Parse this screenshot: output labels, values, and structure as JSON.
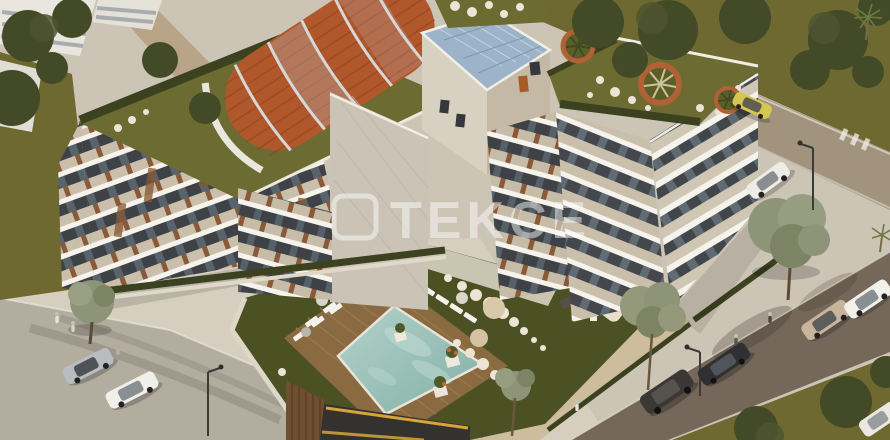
{
  "watermark": {
    "text": "TEKCE",
    "color": "#ffffff",
    "opacity": "0.48"
  },
  "palette": {
    "pavement": "#ccc5b6",
    "sidewalk": "#d6cfc0",
    "road_light": "#b3ada0",
    "road_top": "#a2937f",
    "road_brown": "#75685a",
    "grass": "#6e6930",
    "lawn": "#4c5124",
    "hedge": "#3c4220",
    "sedum": "#6c6b32",
    "tree_dark": "#434a27",
    "tree_gray": "#8d9478",
    "facade_cream": "#d8d1c1",
    "facade_tan": "#c3b9a5",
    "facade_gray": "#cac3b6",
    "slab_white": "#f5f3ec",
    "glass_dark": "#3e4246",
    "wood": "#86562f",
    "arch_orange": "#b0572b",
    "arch_rib": "#d6d7d6",
    "tower_blue": "#9cb3c9",
    "pool_light": "#b2d2c9",
    "pool_deep": "#83b0a6",
    "deck_wood": "#8a6a40",
    "lounger": "#f4f2ec",
    "umbrella_cream": "#e9dfcb",
    "stone": "#ece5d6",
    "planter_ring": "#b06234",
    "garage_dark": "#33322e",
    "garage_stripe": "#d8a53a",
    "wood_wall": "#6f4f30",
    "white_building": "#e9e6df"
  },
  "scene": {
    "type": "aerial 3D architectural render",
    "subject": "U-shaped residential apartment complex with rooftop gardens, barrel pergola roof, courtyard pool and surrounding streets",
    "building": {
      "wings": [
        "west wing",
        "north wing with elevator tower",
        "east wing"
      ],
      "roof_features": [
        "terracotta barrel pergola",
        "blue glass tower roof",
        "sedum green roofs with palm planters",
        "white stepping stones"
      ]
    },
    "pool": {
      "shape": "diamond",
      "loungers": 12,
      "umbrellas": 4
    },
    "courtyard": {
      "features": [
        "wood deck",
        "dark lawn",
        "white stepping stones",
        "cream cabana",
        "olive trees",
        "flower planters"
      ]
    },
    "cars": [
      {
        "label": "silver-sedan-bottom-left",
        "color": "#b9bdc1"
      },
      {
        "label": "white-sedan-bottom-left",
        "color": "#f1efe9"
      },
      {
        "label": "dark-sedan-bottom-right",
        "color": "#2e3032"
      },
      {
        "label": "beige-sedan-bottom-right",
        "color": "#c7b59b"
      },
      {
        "label": "white-sedan-right-edge",
        "color": "#f2f0ea"
      },
      {
        "label": "dark-suv-bottom-right",
        "color": "#3a3734"
      },
      {
        "label": "white-car-parked-right",
        "color": "#eeece6"
      },
      {
        "label": "yellow-car-top-right",
        "color": "#d4c651"
      },
      {
        "label": "white-van-corner",
        "color": "#ebe8e1"
      }
    ],
    "people_count": 6,
    "street_lamps": 3
  }
}
